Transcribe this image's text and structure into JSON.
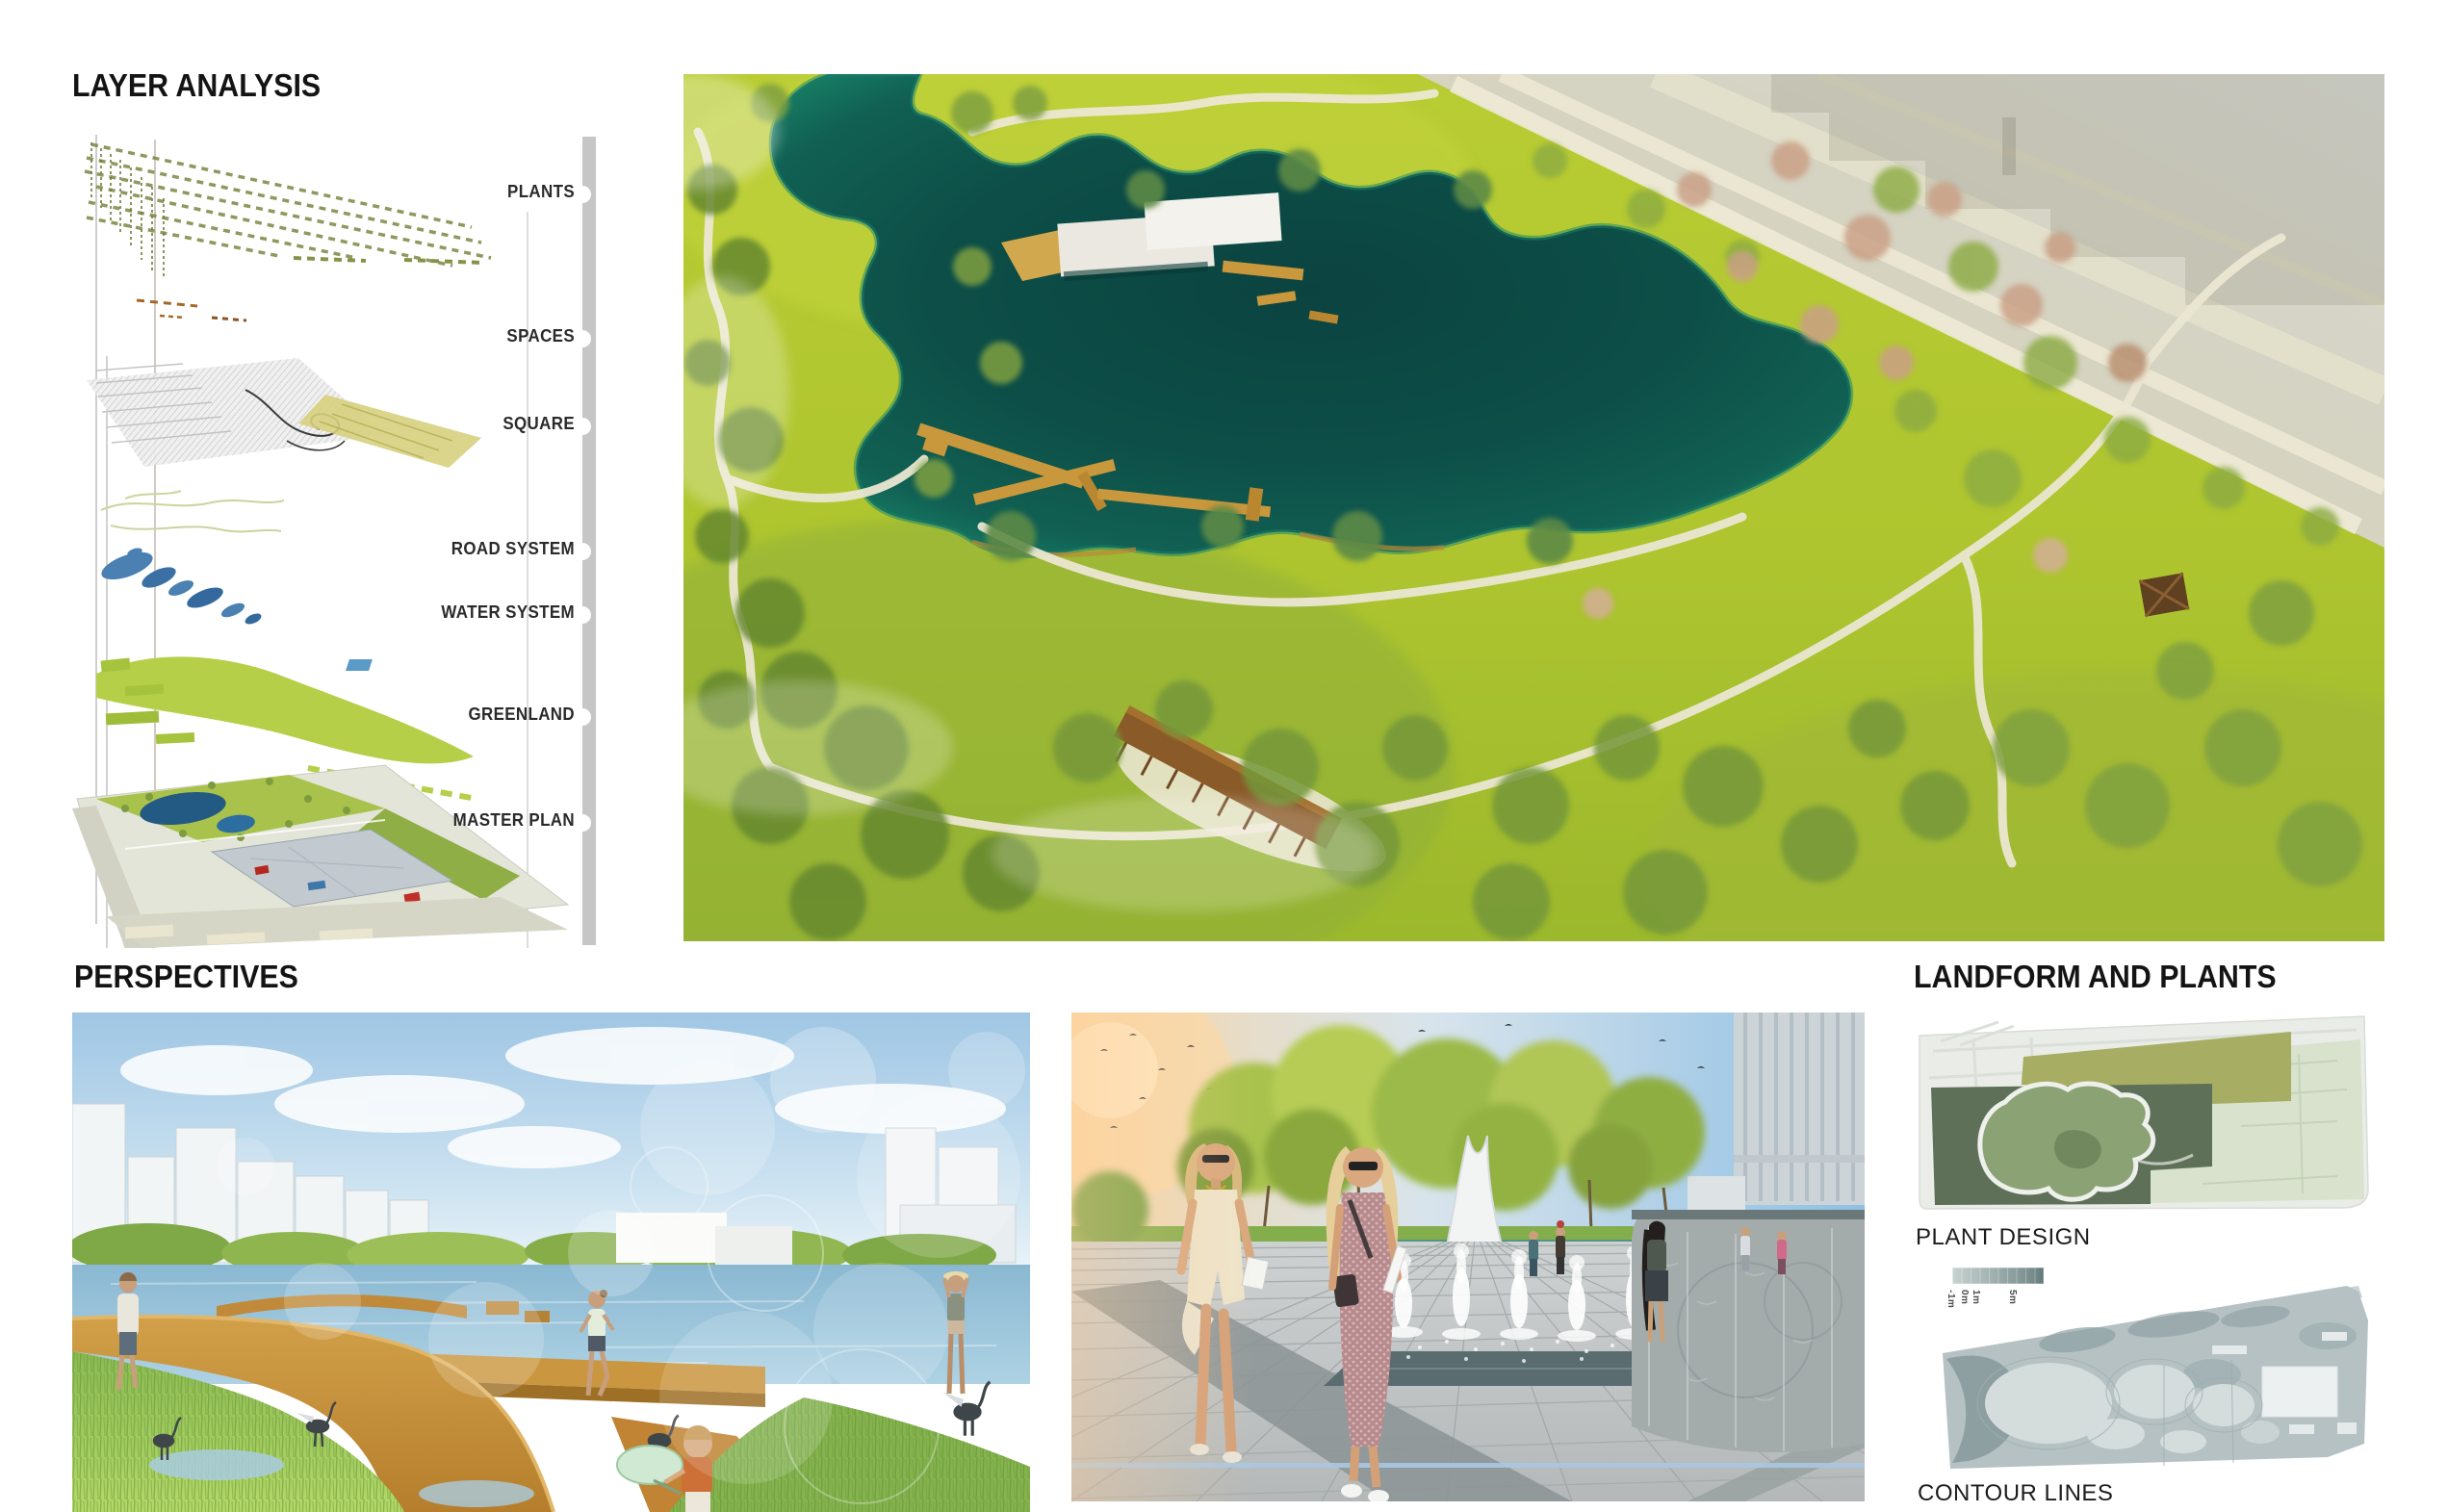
{
  "layer_analysis": {
    "title": "LAYER ANALYSIS",
    "layers": [
      {
        "label": "PLANTS"
      },
      {
        "label": "SPACES"
      },
      {
        "label": "SQUARE"
      },
      {
        "label": "ROAD SYSTEM"
      },
      {
        "label": "WATER SYSTEM"
      },
      {
        "label": "GREENLAND"
      },
      {
        "label": "MASTER PLAN"
      }
    ]
  },
  "perspectives": {
    "title": "PERSPECTIVES"
  },
  "landform": {
    "title": "LANDFORM AND PLANTS",
    "plant_design_label": "PLANT DESIGN",
    "contour_lines_label": "CONTOUR LINES",
    "legend_ticks": [
      "-1m",
      "0m",
      "1m",
      "5m"
    ]
  },
  "palette": {
    "lake_teal": "#0d4f48",
    "park_green": "#b3c832",
    "boardwalk_orange": "#c08a3a",
    "water_blue": "#8ab8d2",
    "city_beige": "#d9d5bb"
  }
}
